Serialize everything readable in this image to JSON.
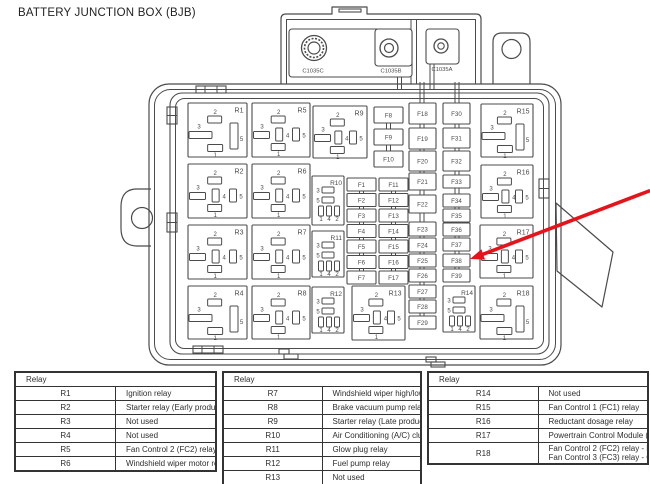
{
  "title": "BATTERY JUNCTION BOX (BJB)",
  "diagram": {
    "connector_labels": [
      "C1035C",
      "C1035B",
      "C1035A"
    ],
    "pin_sets": {
      "A": [
        "2",
        "3",
        "5",
        "1"
      ],
      "B": [
        "2",
        "3",
        "4",
        "5",
        "1"
      ],
      "C": [
        "3",
        "5",
        "1",
        "4",
        "2"
      ]
    },
    "relays": [
      {
        "id": "R1",
        "type": "A"
      },
      {
        "id": "R2",
        "type": "B"
      },
      {
        "id": "R3",
        "type": "B"
      },
      {
        "id": "R4",
        "type": "A"
      },
      {
        "id": "R5",
        "type": "B"
      },
      {
        "id": "R6",
        "type": "B"
      },
      {
        "id": "R7",
        "type": "B"
      },
      {
        "id": "R8",
        "type": "B"
      },
      {
        "id": "R9",
        "type": "B"
      },
      {
        "id": "R10",
        "type": "C"
      },
      {
        "id": "R11",
        "type": "C"
      },
      {
        "id": "R12",
        "type": "C"
      },
      {
        "id": "R13",
        "type": "B"
      },
      {
        "id": "R14",
        "type": "C"
      },
      {
        "id": "R15",
        "type": "A"
      },
      {
        "id": "R16",
        "type": "B"
      },
      {
        "id": "R17",
        "type": "B"
      },
      {
        "id": "R18",
        "type": "A"
      }
    ],
    "fuses": [
      "F1",
      "F2",
      "F3",
      "F4",
      "F5",
      "F6",
      "F7",
      "F8",
      "F9",
      "F10",
      "F11",
      "F12",
      "F13",
      "F14",
      "F15",
      "F16",
      "F17",
      "F18",
      "F19",
      "F20",
      "F21",
      "F22",
      "F23",
      "F24",
      "F25",
      "F26",
      "F27",
      "F28",
      "F29",
      "F30",
      "F31",
      "F32",
      "F33",
      "F34",
      "F35",
      "F36",
      "F37",
      "F38",
      "F39"
    ],
    "arrow_points_to": "F38",
    "colors": {
      "line": "#4b4b4b",
      "text": "#4a4a4a",
      "arrow": "#e8131a"
    }
  },
  "tables": [
    {
      "header": "Relay",
      "rows": [
        [
          "R1",
          "Ignition relay"
        ],
        [
          "R2",
          "Starter relay (Early production)"
        ],
        [
          "R3",
          "Not used"
        ],
        [
          "R4",
          "Not used"
        ],
        [
          "R5",
          "Fan Control 2 (FC2) relay - Gasoline"
        ],
        [
          "R6",
          "Windshield wiper motor relay"
        ]
      ]
    },
    {
      "header": "Relay",
      "rows": [
        [
          "R7",
          "Windshield wiper high/low speed relay"
        ],
        [
          "R8",
          "Brake vacuum pump relay"
        ],
        [
          "R9",
          "Starter relay (Late production)"
        ],
        [
          "R10",
          "Air Conditioning (A/C) clutch relay"
        ],
        [
          "R11",
          "Glow plug relay"
        ],
        [
          "R12",
          "Fuel pump relay"
        ],
        [
          "R13",
          "Not used"
        ]
      ]
    },
    {
      "header": "Relay",
      "rows": [
        [
          "R14",
          "Not used"
        ],
        [
          "R15",
          "Fan Control 1 (FC1) relay"
        ],
        [
          "R16",
          "Reductant dosage relay"
        ],
        [
          "R17",
          "Powertrain Control Module (PCM) relay"
        ],
        [
          "R18",
          "Fan Control 2 (FC2) relay - Diesel\nFan Control 3 (FC3) relay - Gasoline"
        ]
      ]
    }
  ]
}
